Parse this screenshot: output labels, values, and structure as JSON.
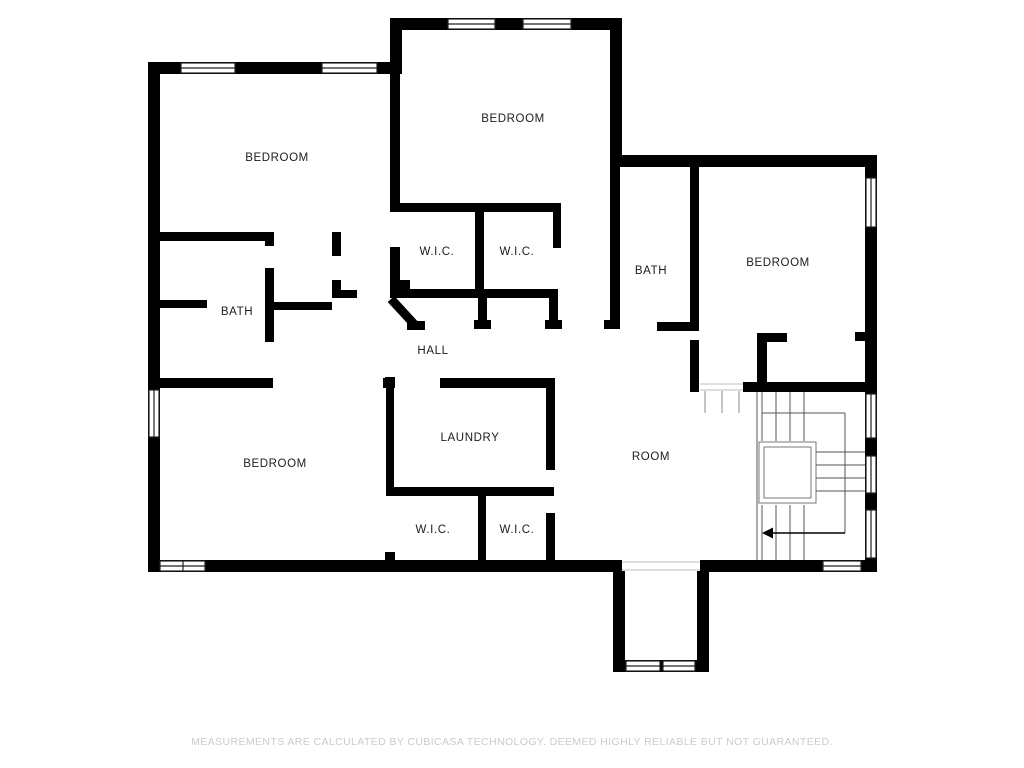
{
  "floorplan": {
    "type": "floor-plan",
    "background_color": "#ffffff",
    "wall_color": "#000000",
    "label_color": "#1c1c1c",
    "stair_line_color": "#555555",
    "rooms": [
      {
        "id": "bedroom-top-left",
        "label": "BEDROOM"
      },
      {
        "id": "bedroom-top-middle",
        "label": "BEDROOM"
      },
      {
        "id": "bedroom-right",
        "label": "BEDROOM"
      },
      {
        "id": "bedroom-bottom-left",
        "label": "BEDROOM"
      },
      {
        "id": "bath-left",
        "label": "BATH"
      },
      {
        "id": "bath-middle",
        "label": "BATH"
      },
      {
        "id": "wic-upper-left",
        "label": "W.I.C."
      },
      {
        "id": "wic-upper-right",
        "label": "W.I.C."
      },
      {
        "id": "hall",
        "label": "HALL"
      },
      {
        "id": "laundry",
        "label": "LAUNDRY"
      },
      {
        "id": "wic-lower-left",
        "label": "W.I.C."
      },
      {
        "id": "wic-lower-right",
        "label": "W.I.C."
      },
      {
        "id": "room",
        "label": "ROOM"
      }
    ],
    "stairs": {
      "arrow_icon": "stair-direction-arrow",
      "arrow_direction": "left"
    }
  },
  "footer": {
    "disclaimer": "MEASUREMENTS ARE CALCULATED BY CUBICASA TECHNOLOGY. DEEMED HIGHLY RELIABLE BUT NOT GUARANTEED.",
    "color": "#c9cbcd"
  }
}
